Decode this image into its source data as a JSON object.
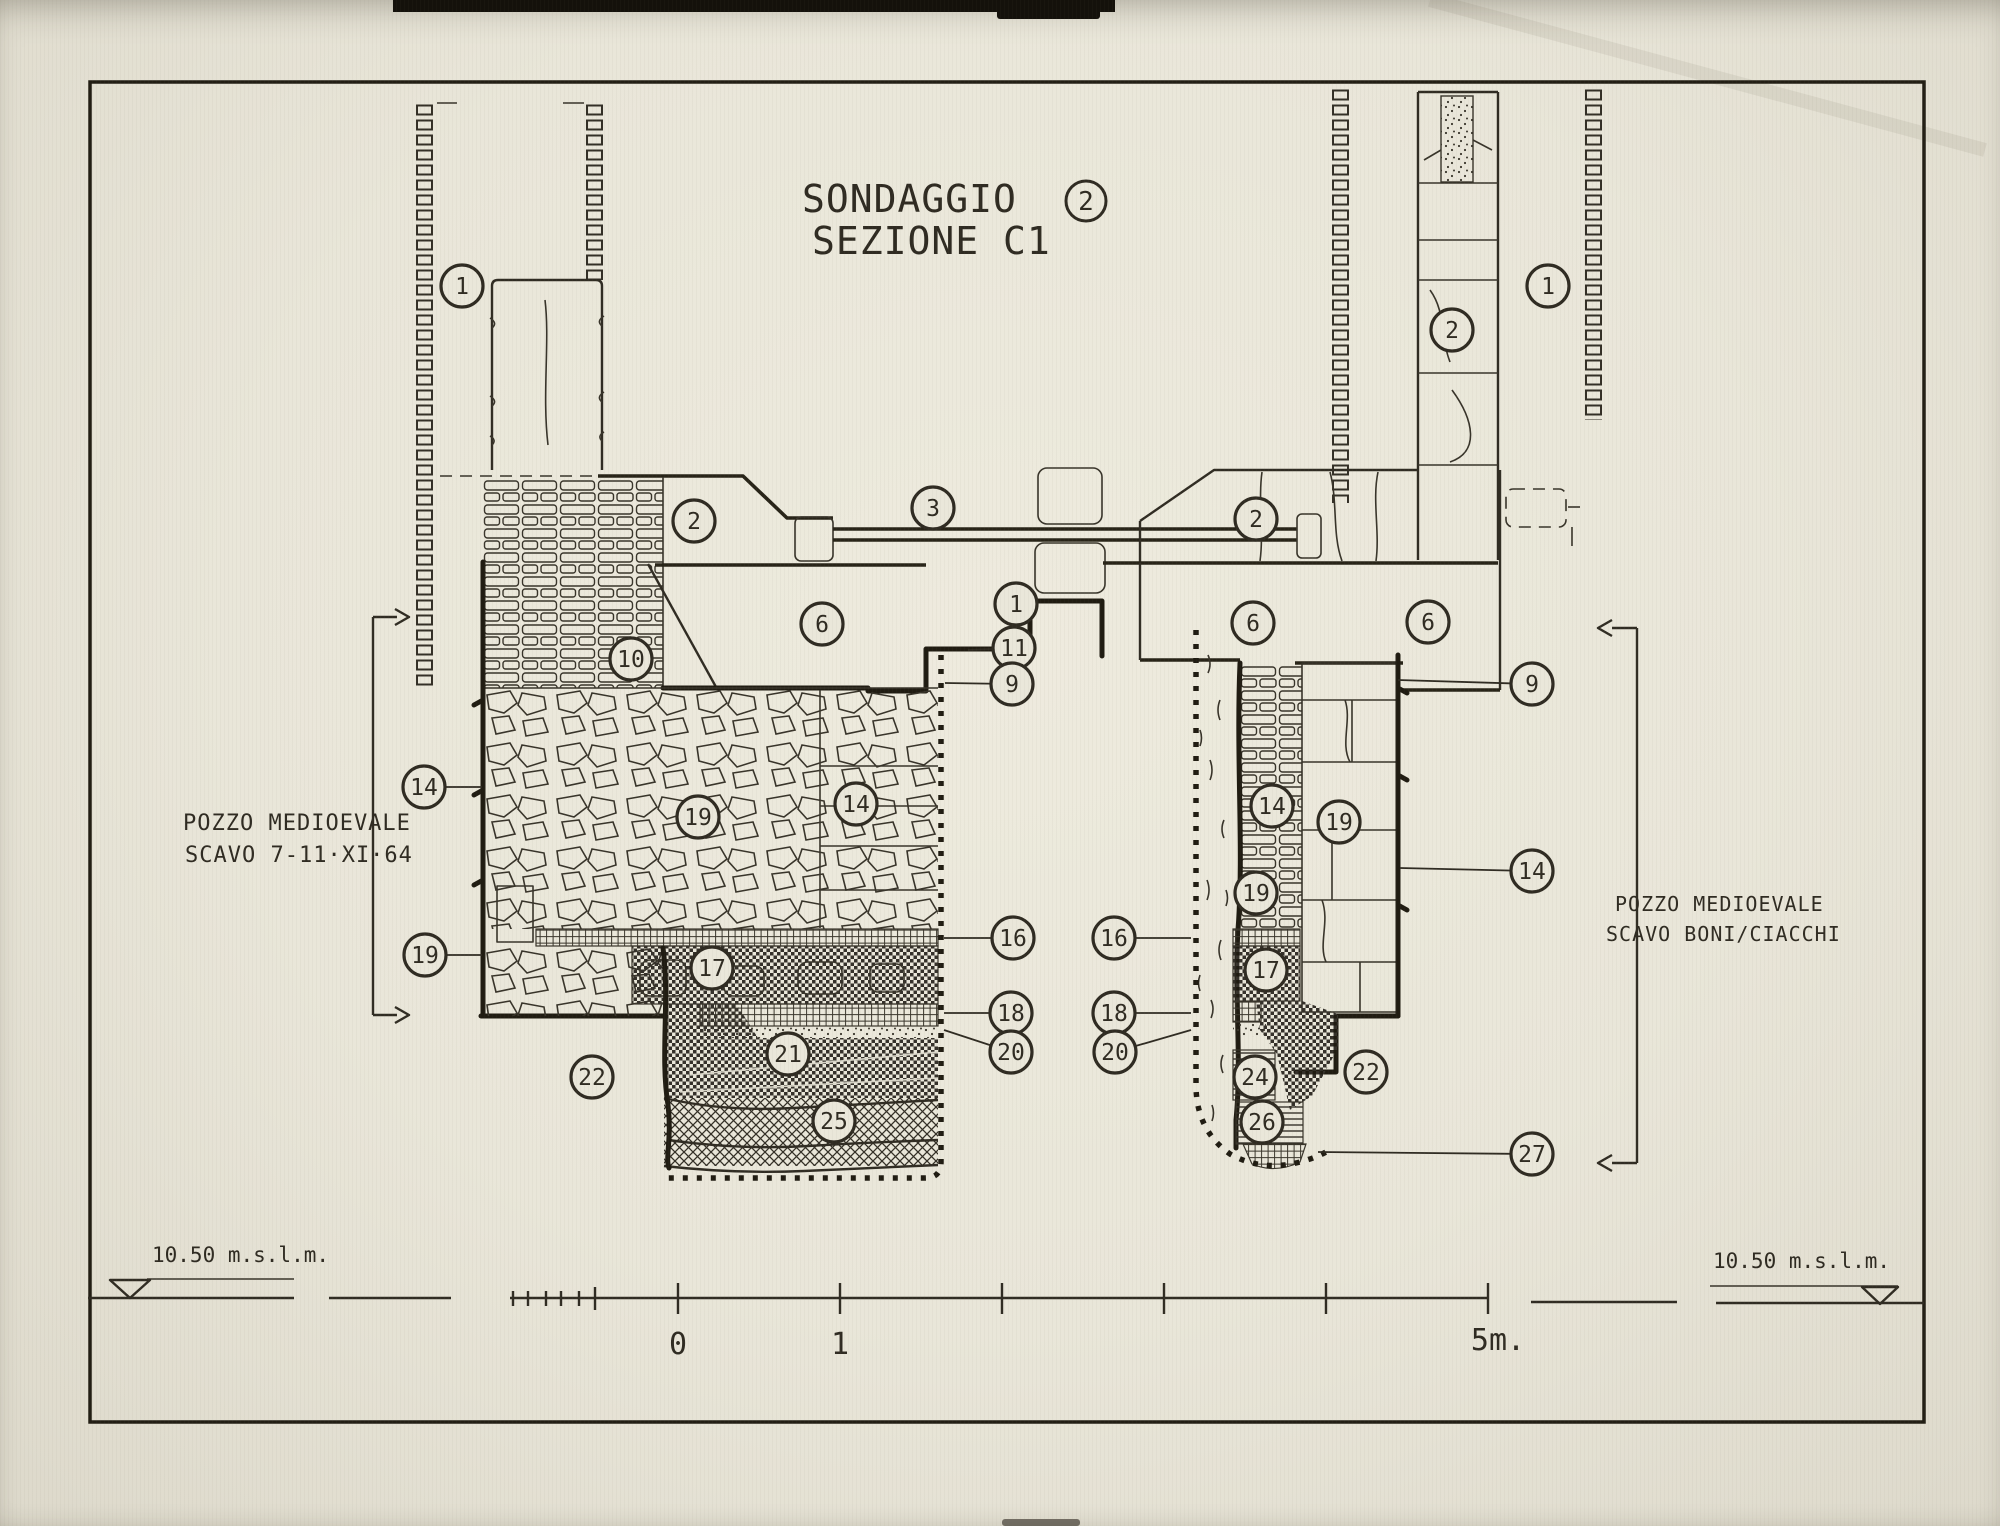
{
  "colors": {
    "paper": "#eae7da",
    "ink": "#2f2b22"
  },
  "title": {
    "line1": "SONDAGGIO",
    "badge": "2",
    "line2": "SEZIONE  C1"
  },
  "notes": {
    "left": {
      "line1": "POZZO MEDIOEVALE",
      "line2": "SCAVO  7-11·XI·64"
    },
    "right": {
      "line1": "POZZO  MEDIOEVALE",
      "line2": "SCAVO  BONI/CIACCHI"
    }
  },
  "datum": {
    "left": "10.50 m.s.l.m.",
    "right": "10.50 m.s.l.m."
  },
  "scale": {
    "zero": "0",
    "one": "1",
    "five": "5m."
  },
  "callouts": [
    {
      "n": "1",
      "x": 462,
      "y": 286
    },
    {
      "n": "2",
      "x": 1452,
      "y": 330
    },
    {
      "n": "1",
      "x": 1548,
      "y": 286
    },
    {
      "n": "2",
      "x": 694,
      "y": 521
    },
    {
      "n": "3",
      "x": 933,
      "y": 508
    },
    {
      "n": "2",
      "x": 1256,
      "y": 519
    },
    {
      "n": "6",
      "x": 822,
      "y": 624
    },
    {
      "n": "1",
      "x": 1016,
      "y": 604,
      "lx": 1031,
      "ly": 600
    },
    {
      "n": "11",
      "x": 1014,
      "y": 648,
      "lx": 968,
      "ly": 650
    },
    {
      "n": "9",
      "x": 1012,
      "y": 684,
      "lx": 945,
      "ly": 683
    },
    {
      "n": "6",
      "x": 1253,
      "y": 623
    },
    {
      "n": "6",
      "x": 1428,
      "y": 622
    },
    {
      "n": "9",
      "x": 1532,
      "y": 684,
      "lx": 1398,
      "ly": 680
    },
    {
      "n": "10",
      "x": 631,
      "y": 659
    },
    {
      "n": "14",
      "x": 424,
      "y": 787,
      "lx": 482,
      "ly": 787
    },
    {
      "n": "19",
      "x": 698,
      "y": 817
    },
    {
      "n": "14",
      "x": 856,
      "y": 804
    },
    {
      "n": "14",
      "x": 1272,
      "y": 806
    },
    {
      "n": "19",
      "x": 1339,
      "y": 822
    },
    {
      "n": "19",
      "x": 1256,
      "y": 893
    },
    {
      "n": "14",
      "x": 1532,
      "y": 871,
      "lx": 1400,
      "ly": 868
    },
    {
      "n": "19",
      "x": 425,
      "y": 955,
      "lx": 482,
      "ly": 955
    },
    {
      "n": "16",
      "x": 1013,
      "y": 938,
      "lx": 944,
      "ly": 938
    },
    {
      "n": "16",
      "x": 1114,
      "y": 938,
      "lx": 1191,
      "ly": 938
    },
    {
      "n": "17",
      "x": 712,
      "y": 968
    },
    {
      "n": "17",
      "x": 1266,
      "y": 970
    },
    {
      "n": "18",
      "x": 1011,
      "y": 1013,
      "lx": 944,
      "ly": 1013
    },
    {
      "n": "18",
      "x": 1114,
      "y": 1013,
      "lx": 1191,
      "ly": 1013
    },
    {
      "n": "20",
      "x": 1011,
      "y": 1052,
      "lx": 944,
      "ly": 1030
    },
    {
      "n": "20",
      "x": 1115,
      "y": 1052,
      "lx": 1191,
      "ly": 1030
    },
    {
      "n": "21",
      "x": 788,
      "y": 1054
    },
    {
      "n": "22",
      "x": 592,
      "y": 1077
    },
    {
      "n": "22",
      "x": 1366,
      "y": 1072
    },
    {
      "n": "24",
      "x": 1255,
      "y": 1077
    },
    {
      "n": "25",
      "x": 834,
      "y": 1121
    },
    {
      "n": "26",
      "x": 1262,
      "y": 1122
    },
    {
      "n": "27",
      "x": 1532,
      "y": 1154,
      "lx": 1318,
      "ly": 1152
    }
  ]
}
